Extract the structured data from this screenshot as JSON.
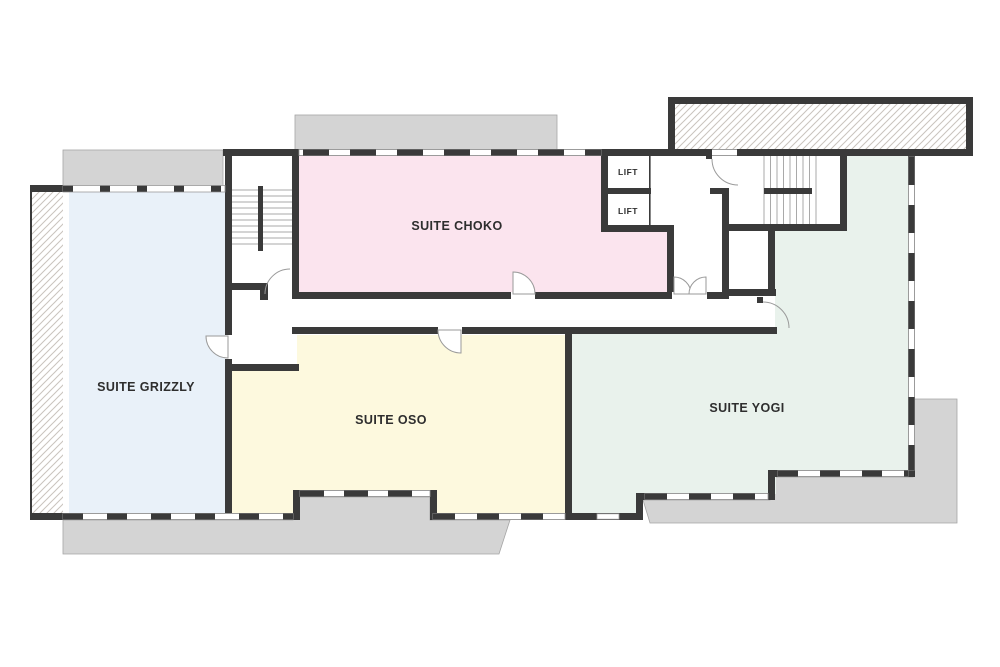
{
  "plan": {
    "title": "floor-plan",
    "rooms": [
      {
        "id": "suite-grizzly",
        "label": "SUITE GRIZZLY",
        "color": "#e9f1f9"
      },
      {
        "id": "suite-choko",
        "label": "SUITE CHOKO",
        "color": "#fbe4ee"
      },
      {
        "id": "suite-oso",
        "label": "SUITE OSO",
        "color": "#fdf9de"
      },
      {
        "id": "suite-yogi",
        "label": "SUITE YOGI",
        "color": "#e9f2ec"
      }
    ],
    "lifts": [
      {
        "label": "LIFT"
      },
      {
        "label": "LIFT"
      }
    ],
    "colors": {
      "wall": "#3a3a3a",
      "terrace": "#d4d4d4",
      "terrace_outline": "#a5a5a5",
      "hatch_line": "#c9c3bd",
      "stair_line": "#a9a9a9",
      "door_arc": "#9a9a9a",
      "window_frame": "#9b9b9b",
      "label_text": "#2e2e2e"
    }
  }
}
